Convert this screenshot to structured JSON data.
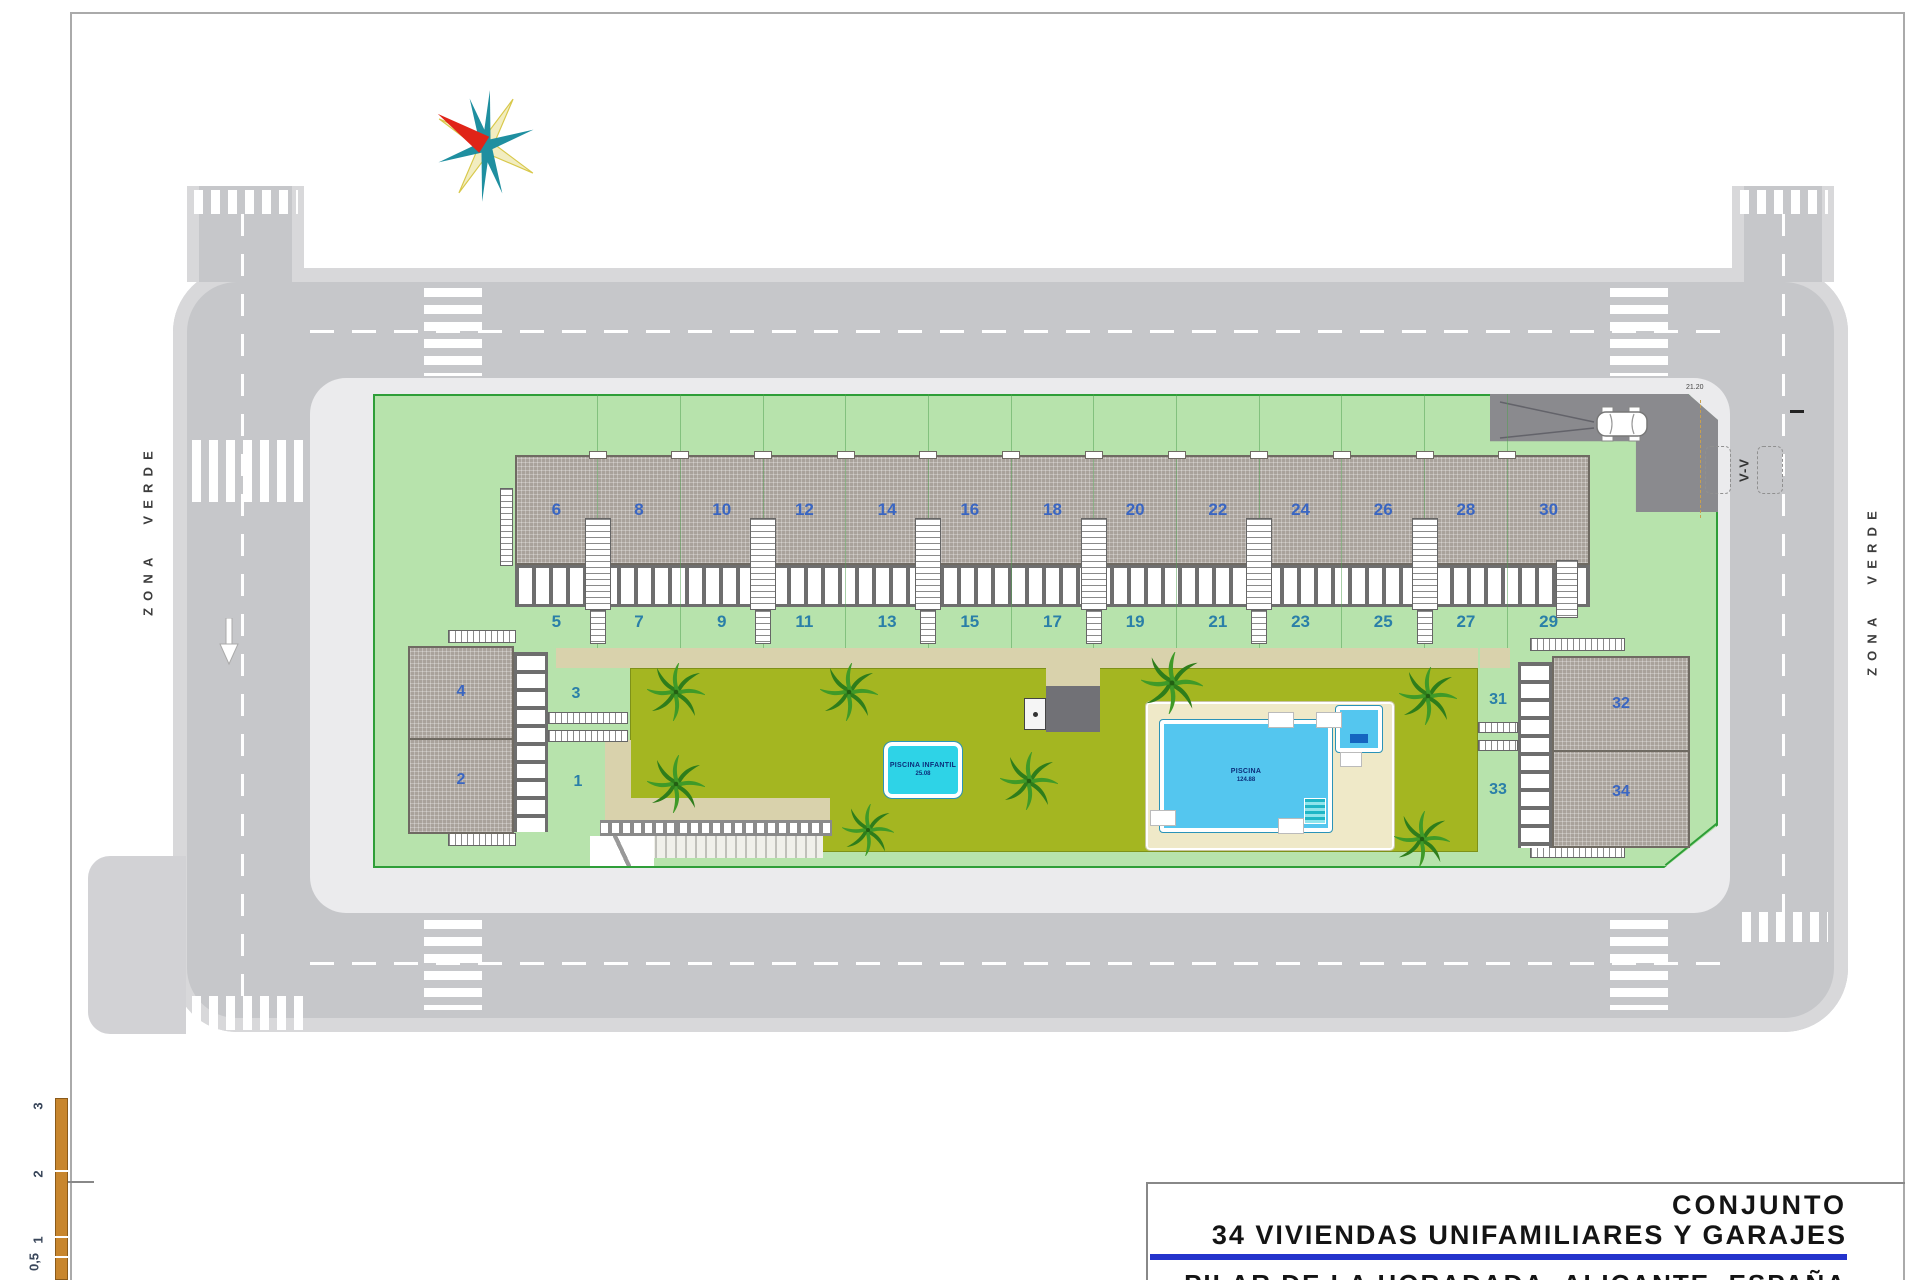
{
  "titleblock": {
    "line1": "CONJUNTO",
    "line2": "34 VIVIENDAS UNIFAMILIARES Y GARAJES",
    "line3": "PILAR DE LA HORADADA, ALICANTE, ESPAÑA"
  },
  "labels": {
    "zona_verde": "ZONA VERDE",
    "v_v": "V-V",
    "driveway_dim": "21.20"
  },
  "houses": {
    "row_upper": [
      "6",
      "8",
      "10",
      "12",
      "14",
      "16",
      "18",
      "20",
      "22",
      "24",
      "26",
      "28",
      "30"
    ],
    "row_lower": [
      "5",
      "7",
      "9",
      "11",
      "13",
      "15",
      "17",
      "19",
      "21",
      "23",
      "25",
      "27",
      "29"
    ]
  },
  "buildings": {
    "left": {
      "roof_upper": "4",
      "roof_lower": "2",
      "plot_upper": "3",
      "plot_lower": "1"
    },
    "right": {
      "roof_upper": "32",
      "roof_lower": "34",
      "plot_upper": "31",
      "plot_lower": "33"
    }
  },
  "pools": {
    "small": {
      "name": "PISCINA INFANTIL",
      "area": "25.08"
    },
    "large": {
      "name": "PISCINA",
      "area": "124.88"
    }
  },
  "scalebar": {
    "ticks": [
      "3",
      "2",
      "1",
      "0,5"
    ]
  },
  "colors": {
    "accent_rule": "#2433cc",
    "number_upper": "#3a66c2",
    "number_lower": "#2a7fa8",
    "plot_green": "#b7e3ac",
    "plot_border": "#2e9e38",
    "garden_lime": "#a4b621",
    "road_gray": "#c6c7ca",
    "sidewalk_gray": "#d8d8da",
    "inner_gray": "#ebebed",
    "roof_gray": "#a9a29b",
    "path_beige": "#d9d2ac",
    "pool_cyan": "#2ed3e7",
    "pool_blue": "#54c6ef",
    "deck_cream": "#efe9c8",
    "driveway_dark": "#8a8a8e",
    "scalebar_orange": "#c8862e",
    "tree_green": "#2e7d1b"
  }
}
